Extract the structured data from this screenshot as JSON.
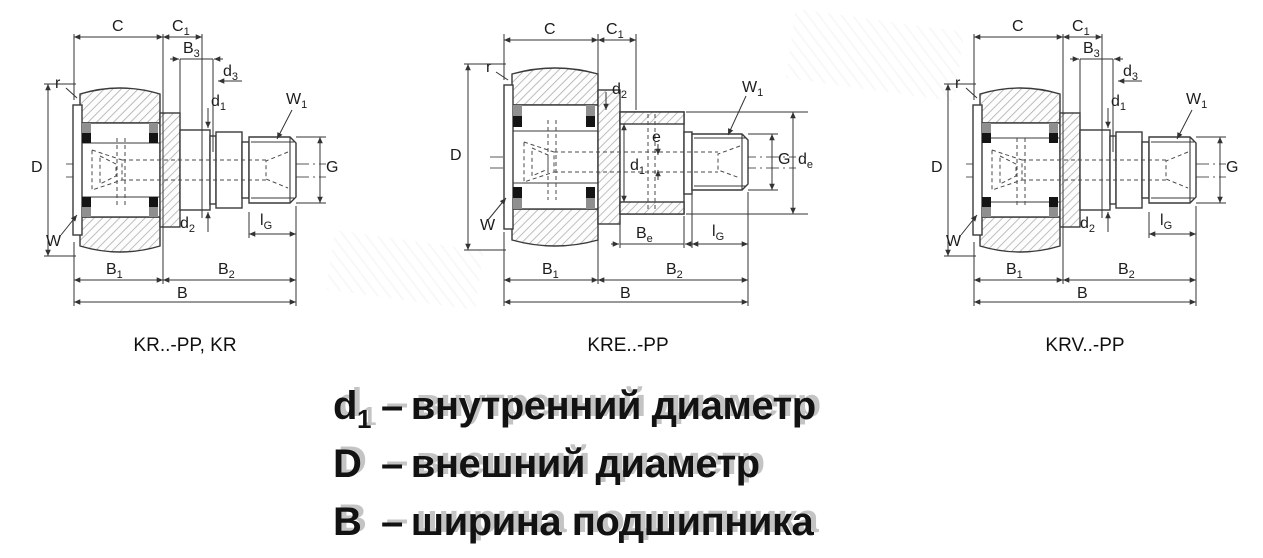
{
  "colors": {
    "line": "#3a3a3a",
    "hatch": "#a9a9a9",
    "text": "#111111"
  },
  "diagrams": [
    {
      "id": "kr",
      "caption": "KR..-PP, KR",
      "labels": {
        "C": {
          "m": "C",
          "s": ""
        },
        "C1": {
          "m": "C",
          "s": "1"
        },
        "B3": {
          "m": "B",
          "s": "3"
        },
        "d3": {
          "m": "d",
          "s": "3"
        },
        "d1": {
          "m": "d",
          "s": "1"
        },
        "W1": {
          "m": "W",
          "s": "1"
        },
        "r": {
          "m": "r",
          "s": ""
        },
        "D": {
          "m": "D",
          "s": ""
        },
        "G": {
          "m": "G",
          "s": ""
        },
        "d2": {
          "m": "d",
          "s": "2"
        },
        "lG": {
          "m": "l",
          "s": "G"
        },
        "W": {
          "m": "W",
          "s": ""
        },
        "B1": {
          "m": "B",
          "s": "1"
        },
        "B2": {
          "m": "B",
          "s": "2"
        },
        "B": {
          "m": "B",
          "s": ""
        }
      }
    },
    {
      "id": "kre",
      "caption": "KRE..-PP",
      "labels": {
        "C": {
          "m": "C",
          "s": ""
        },
        "C1": {
          "m": "C",
          "s": "1"
        },
        "r": {
          "m": "r",
          "s": ""
        },
        "D": {
          "m": "D",
          "s": ""
        },
        "d2": {
          "m": "d",
          "s": "2"
        },
        "W1": {
          "m": "W",
          "s": "1"
        },
        "e": {
          "m": "e",
          "s": ""
        },
        "d1": {
          "m": "d",
          "s": "1"
        },
        "G": {
          "m": "G",
          "s": ""
        },
        "de": {
          "m": "d",
          "s": "e"
        },
        "W": {
          "m": "W",
          "s": ""
        },
        "Be": {
          "m": "B",
          "s": "e"
        },
        "lG": {
          "m": "l",
          "s": "G"
        },
        "B1": {
          "m": "B",
          "s": "1"
        },
        "B2": {
          "m": "B",
          "s": "2"
        },
        "B": {
          "m": "B",
          "s": ""
        }
      }
    },
    {
      "id": "krv",
      "caption": "KRV..-PP",
      "labels": {
        "C": {
          "m": "C",
          "s": ""
        },
        "C1": {
          "m": "C",
          "s": "1"
        },
        "B3": {
          "m": "B",
          "s": "3"
        },
        "d3": {
          "m": "d",
          "s": "3"
        },
        "d1": {
          "m": "d",
          "s": "1"
        },
        "W1": {
          "m": "W",
          "s": "1"
        },
        "r": {
          "m": "r",
          "s": ""
        },
        "D": {
          "m": "D",
          "s": ""
        },
        "G": {
          "m": "G",
          "s": ""
        },
        "d2": {
          "m": "d",
          "s": "2"
        },
        "lG": {
          "m": "l",
          "s": "G"
        },
        "W": {
          "m": "W",
          "s": ""
        },
        "B1": {
          "m": "B",
          "s": "1"
        },
        "B2": {
          "m": "B",
          "s": "2"
        },
        "B": {
          "m": "B",
          "s": ""
        }
      }
    }
  ],
  "legend": {
    "items": [
      {
        "sym": "d",
        "sub": "1",
        "dash": "–",
        "text": "внутренний диаметр"
      },
      {
        "sym": "D",
        "sub": "",
        "dash": "–",
        "text": "внешний диаметр"
      },
      {
        "sym": "B",
        "sub": "",
        "dash": "–",
        "text": "ширина подшипника"
      }
    ]
  }
}
